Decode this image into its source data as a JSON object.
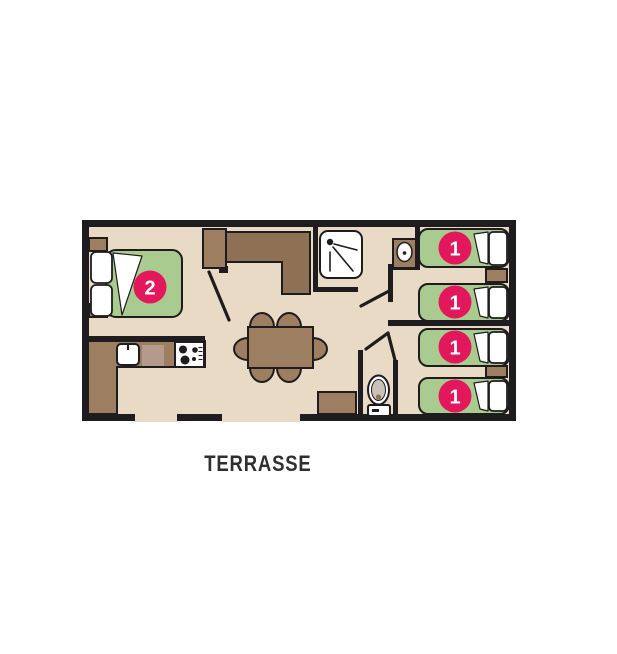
{
  "plan": {
    "terrace_label": "TERRASSE",
    "double_bed": {
      "badge": "2"
    },
    "single_beds": [
      {
        "badge": "1"
      },
      {
        "badge": "1"
      },
      {
        "badge": "1"
      },
      {
        "badge": "1"
      }
    ]
  },
  "colors": {
    "wall": "#1e1c1f",
    "floor": "#e9dac6",
    "furniture_light": "#9d7e60",
    "furniture_dark": "#8e7154",
    "bed_green": "#a9cb8f",
    "badge_pink": "#e3175b",
    "badge_text": "#ffffff",
    "label_text": "#2f2e33",
    "background": "#ffffff"
  }
}
